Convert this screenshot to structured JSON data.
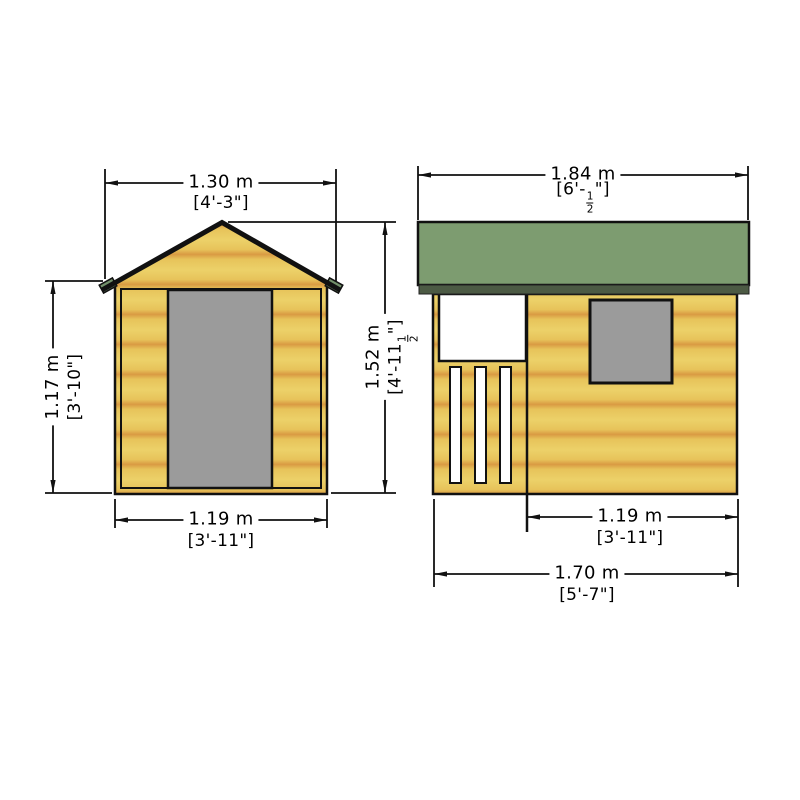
{
  "drawing": {
    "kind": "playhouse-elevation-drawing",
    "views": {
      "front": {
        "id": "front-elevation"
      },
      "side": {
        "id": "side-elevation"
      }
    },
    "dimensions": {
      "front_roof_width": {
        "metric": "1.30 m",
        "imperial": "[4'-3\"]"
      },
      "side_roof_width": {
        "metric": "1.84 m",
        "imperial_prefix": "[6'-",
        "fraction_num": "1",
        "fraction_den": "2",
        "imperial_suffix": "\"]"
      },
      "front_eaves_height": {
        "metric": "1.17 m",
        "imperial": "[3'-10\"]"
      },
      "overall_height": {
        "metric": "1.52 m",
        "imperial_prefix": "[4'-11",
        "fraction_num": "1",
        "fraction_den": "2",
        "imperial_suffix": "\"]"
      },
      "front_base_width": {
        "metric": "1.19 m",
        "imperial": "[3'-11\"]"
      },
      "side_partial_width": {
        "metric": "1.19 m",
        "imperial": "[3'-11\"]"
      },
      "side_base_width": {
        "metric": "1.70 m",
        "imperial": "[5'-7\"]"
      }
    },
    "colors": {
      "background": "#ffffff",
      "wood_light": "#ecd169",
      "wood_mid": "#e7c35a",
      "wood_band": "#d99a43",
      "roof_green": "#7d9c70",
      "fascia_green": "#4c5a44",
      "eave_tab_green": "#72906a",
      "opening_gray": "#9b9b9b",
      "opening_white": "#ffffff",
      "line": "#111111"
    }
  }
}
